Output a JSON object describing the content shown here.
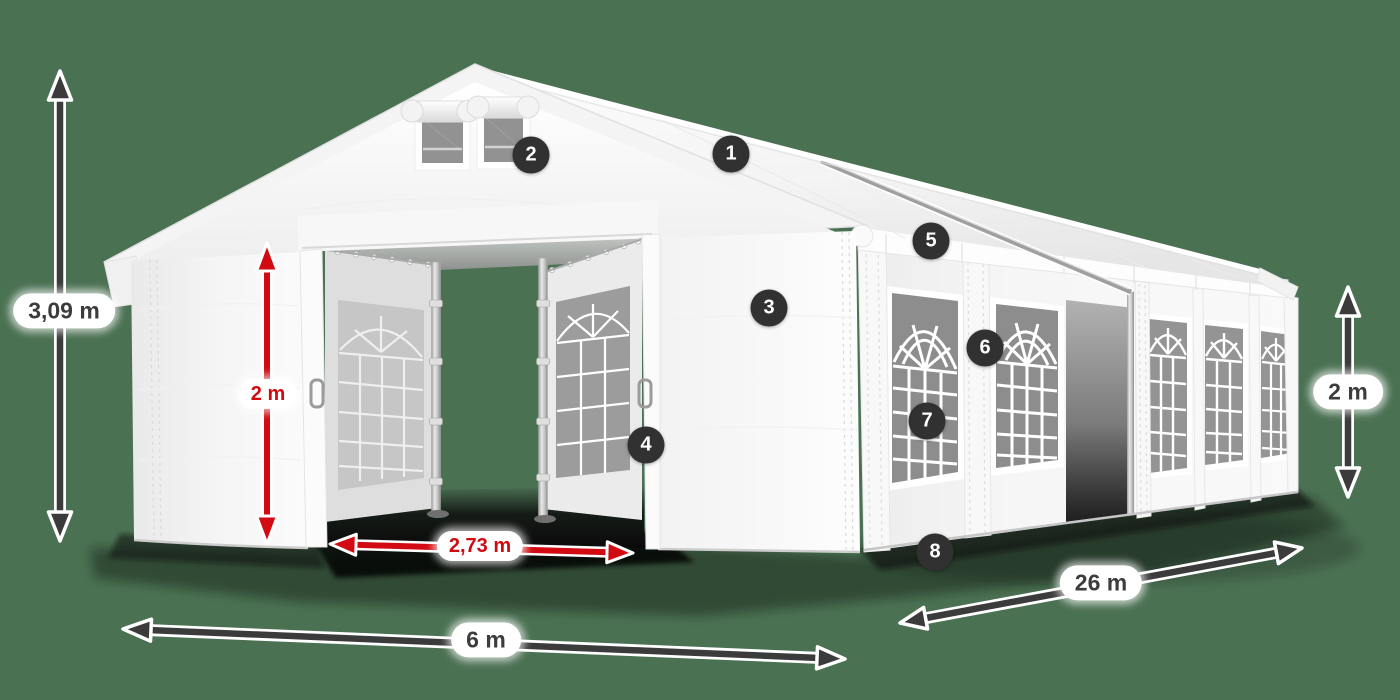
{
  "scene": {
    "background_color": "#4b7153",
    "arrow_dark_color": "#3b3b3b",
    "arrow_red_color": "#d10b11",
    "label_bg_color": "#ffffff",
    "label_text_dark": "#3c3c3c",
    "label_text_red": "#cf0a10",
    "hotspot_bg": "#313131",
    "hotspot_text": "#ffffff",
    "tent_color": "#ffffff"
  },
  "dimensions": [
    {
      "id": "total-height",
      "value": "3,09 m",
      "accent": "dark"
    },
    {
      "id": "entrance-height",
      "value": "2 m",
      "accent": "red"
    },
    {
      "id": "entrance-width",
      "value": "2,73 m",
      "accent": "red"
    },
    {
      "id": "front-width",
      "value": "6 m",
      "accent": "dark"
    },
    {
      "id": "side-length",
      "value": "26 m",
      "accent": "dark"
    },
    {
      "id": "wall-height",
      "value": "2 m",
      "accent": "dark"
    }
  ],
  "hotspots": [
    {
      "number": "1"
    },
    {
      "number": "2"
    },
    {
      "number": "3"
    },
    {
      "number": "4"
    },
    {
      "number": "5"
    },
    {
      "number": "6"
    },
    {
      "number": "7"
    },
    {
      "number": "8"
    }
  ]
}
